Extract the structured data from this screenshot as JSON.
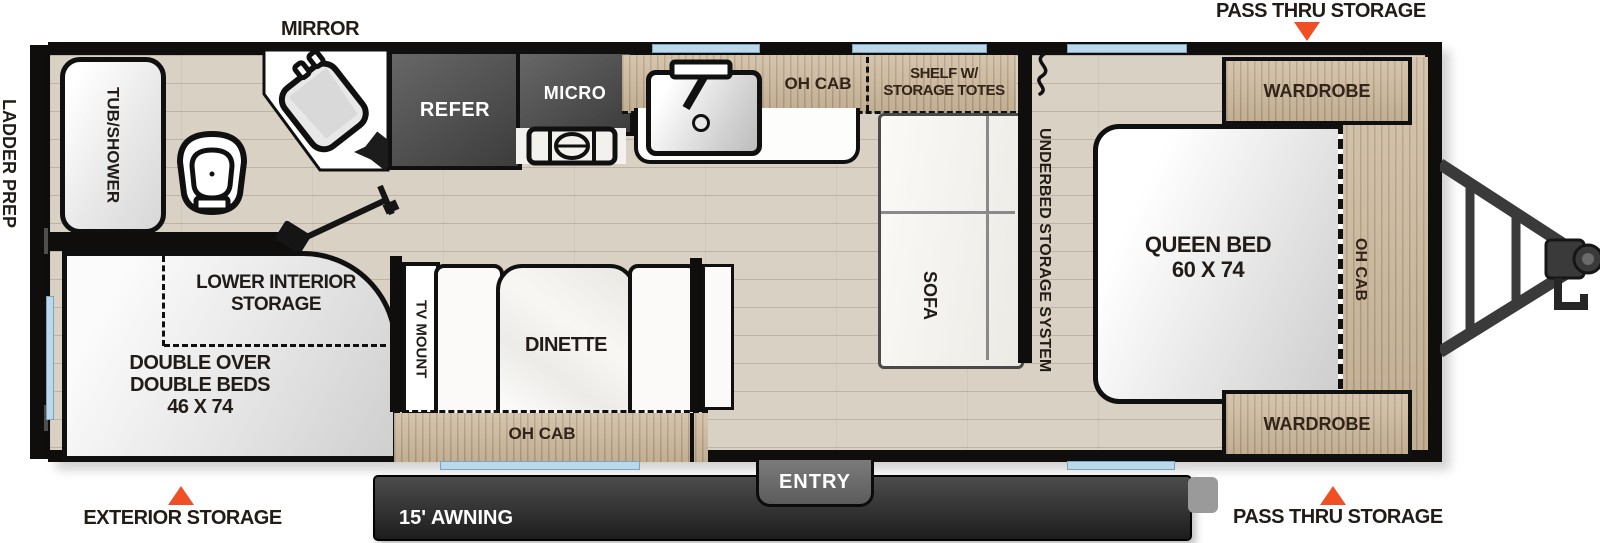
{
  "colors": {
    "accent_orange": "#F04E23",
    "window_blue": "#BCD9EC",
    "wood": "#CDB99C",
    "appliance_dark": "#4A4A4A",
    "floor": "#D9D1C3"
  },
  "exterior": {
    "mirror": "MIRROR",
    "pass_thru_top": "PASS THRU STORAGE",
    "pass_thru_bottom": "PASS THRU STORAGE",
    "exterior_storage": "EXTERIOR STORAGE",
    "awning": "15' AWNING",
    "entry": "ENTRY",
    "ladder_prep": "LADDER PREP"
  },
  "bathroom": {
    "tub_shower": "TUB/SHOWER"
  },
  "kitchen": {
    "refer": "REFER",
    "micro": "MICRO",
    "oh_cab": "OH CAB",
    "shelf_line1": "SHELF W/",
    "shelf_line2": "STORAGE TOTES"
  },
  "living": {
    "sofa": "SOFA",
    "tv_mount": "TV MOUNT",
    "dinette": "DINETTE",
    "oh_cab": "OH CAB"
  },
  "bunk_room": {
    "lower_storage_line1": "LOWER INTERIOR",
    "lower_storage_line2": "STORAGE",
    "beds_line1": "DOUBLE OVER",
    "beds_line2": "DOUBLE BEDS",
    "beds_line3": "46 X 74"
  },
  "bedroom": {
    "underbed": "UNDERBED STORAGE SYSTEM",
    "queen_line1": "QUEEN BED",
    "queen_line2": "60 X 74",
    "wardrobe_top": "WARDROBE",
    "wardrobe_bottom": "WARDROBE",
    "oh_cab": "OH CAB"
  }
}
